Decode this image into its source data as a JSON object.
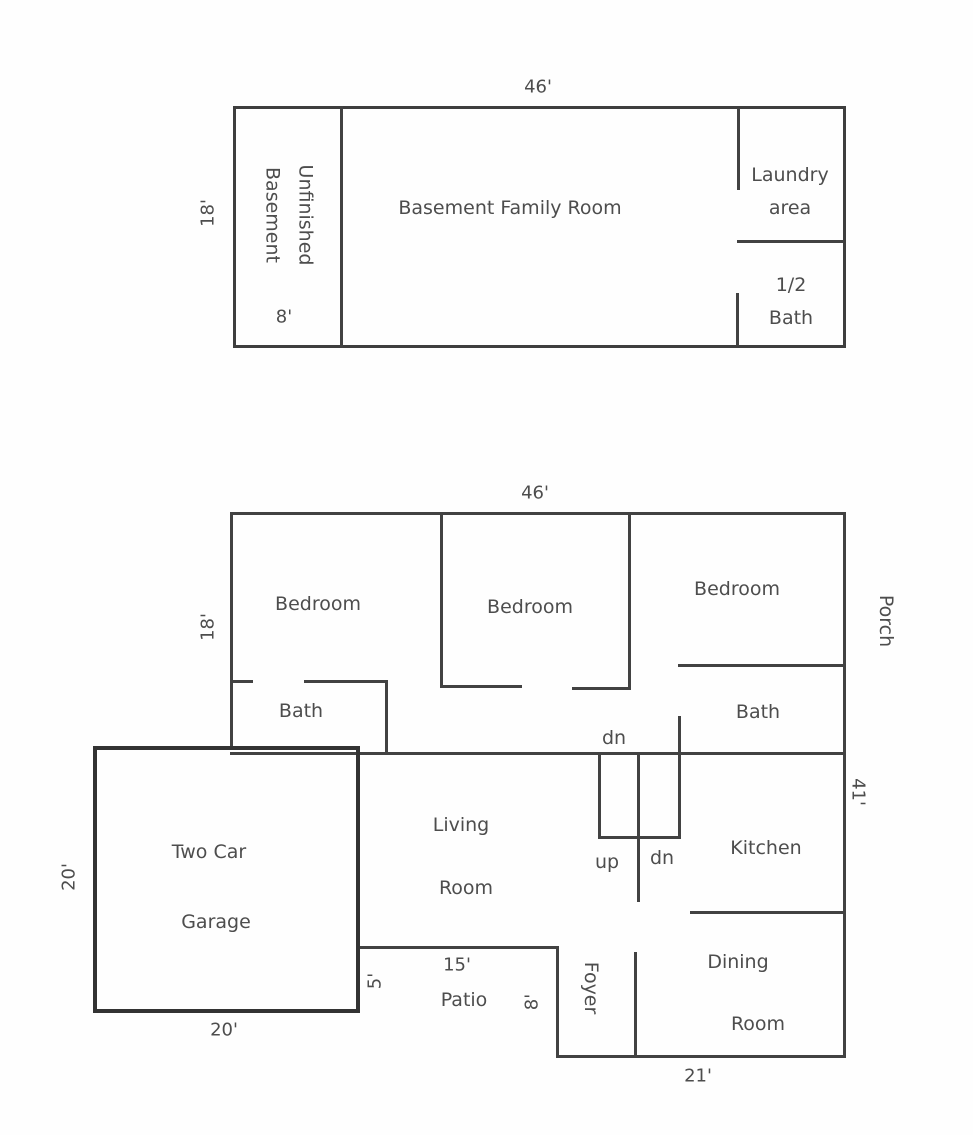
{
  "colors": {
    "wall": "#424242",
    "text": "#4d4d4d",
    "background": "#fefefe"
  },
  "basement_plan": {
    "width_dim": "46'",
    "left_dim": "18'",
    "unfinished_line1": "Unfinished",
    "unfinished_line2": "Basement",
    "unfinished_dim": "8'",
    "family_room": "Basement Family Room",
    "laundry_line1": "Laundry",
    "laundry_line2": "area",
    "half_bath_line1": "1/2",
    "half_bath_line2": "Bath"
  },
  "main_plan": {
    "width_dim": "46'",
    "left_dim": "18'",
    "bedroom1": "Bedroom",
    "bedroom2": "Bedroom",
    "bedroom3": "Bedroom",
    "porch": "Porch",
    "right_dim": "41'",
    "bath_left": "Bath",
    "bath_right": "Bath",
    "dn_hall": "dn",
    "up_label": "up",
    "dn_stairs": "dn",
    "kitchen": "Kitchen",
    "living_line1": "Living",
    "living_line2": "Room",
    "garage_line1": "Two Car",
    "garage_line2": "Garage",
    "garage_width_dim": "20'",
    "garage_left_dim": "20'",
    "patio_side_dim": "5'",
    "patio_width_dim": "15'",
    "patio_label": "Patio",
    "patio_right_dim": "8'",
    "foyer": "Foyer",
    "dining_line1": "Dining",
    "dining_line2": "Room",
    "bottom_dim": "21'"
  }
}
